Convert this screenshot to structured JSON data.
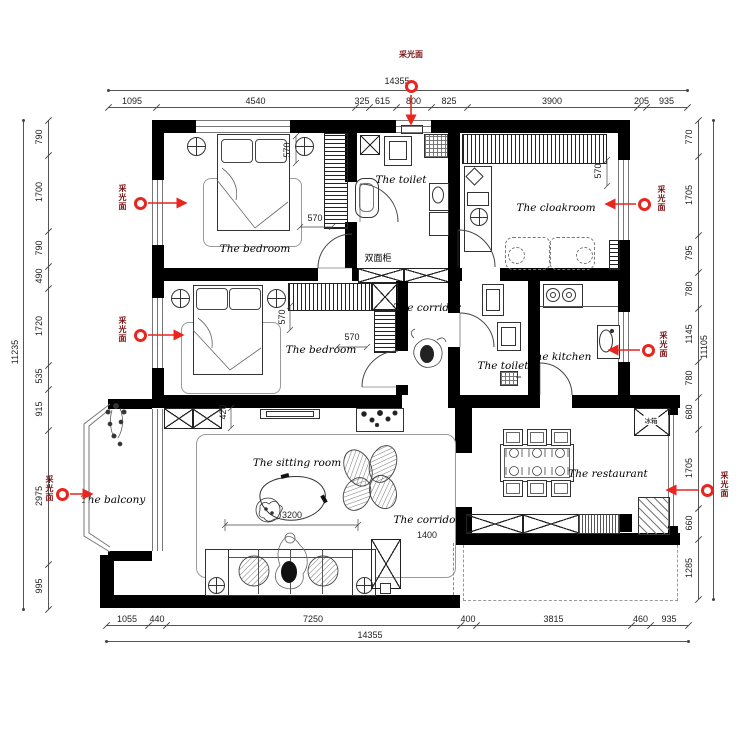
{
  "dimensions": {
    "top": {
      "total": "14355",
      "segments": [
        "1095",
        "4540",
        "325",
        "615",
        "800",
        "825",
        "3900",
        "205",
        "935"
      ]
    },
    "bottom": {
      "total": "14355",
      "segments": [
        "1055",
        "440",
        "7250",
        "400",
        "3815",
        "460",
        "935"
      ]
    },
    "left": {
      "total": "11235",
      "segments": [
        "790",
        "1700",
        "790",
        "490",
        "1720",
        "535",
        "915",
        "2975",
        "995"
      ]
    },
    "right": {
      "total": "11105",
      "segments": [
        "770",
        "1705",
        "795",
        "780",
        "1145",
        "780",
        "680",
        "1705",
        "660",
        "1285"
      ]
    }
  },
  "rooms": {
    "bedroom1": "The bedroom",
    "toilet1": "The toilet",
    "cloakroom": "The cloakroom",
    "bedroom2": "The bedroom",
    "corridor_mid": "The corridor",
    "toilet2": "The toilet",
    "kitchen": "The kitchen",
    "sitting_room": "The sitting room",
    "corridor_lower": "The corridor",
    "restaurant": "The restaurant",
    "balcony": "The balcony"
  },
  "interior_dimensions": {
    "bedroom1_bed": "570",
    "bedroom1_closet": "570",
    "cloakroom_closet": "570",
    "bedroom2_bed": "570",
    "bedroom2_closet": "570",
    "tv_wall": "420",
    "sofa_span": "3200",
    "corridor_width": "1400"
  },
  "annotations": {
    "double_sided_cabinet": "双面柜",
    "fridge": "冰箱"
  },
  "markers": [
    {
      "id": "entry-window",
      "label": "采光面"
    },
    {
      "id": "bedroom1-window",
      "label": "采光面"
    },
    {
      "id": "bedroom2-window",
      "label": "采光面"
    },
    {
      "id": "balcony-window",
      "label": "采光面"
    },
    {
      "id": "cloakroom-window",
      "label": "采光面"
    },
    {
      "id": "kitchen-window",
      "label": "采光面"
    },
    {
      "id": "restaurant-window",
      "label": "采光面"
    }
  ],
  "colors": {
    "marker_red": "#e8251f",
    "wall": "#000000"
  }
}
